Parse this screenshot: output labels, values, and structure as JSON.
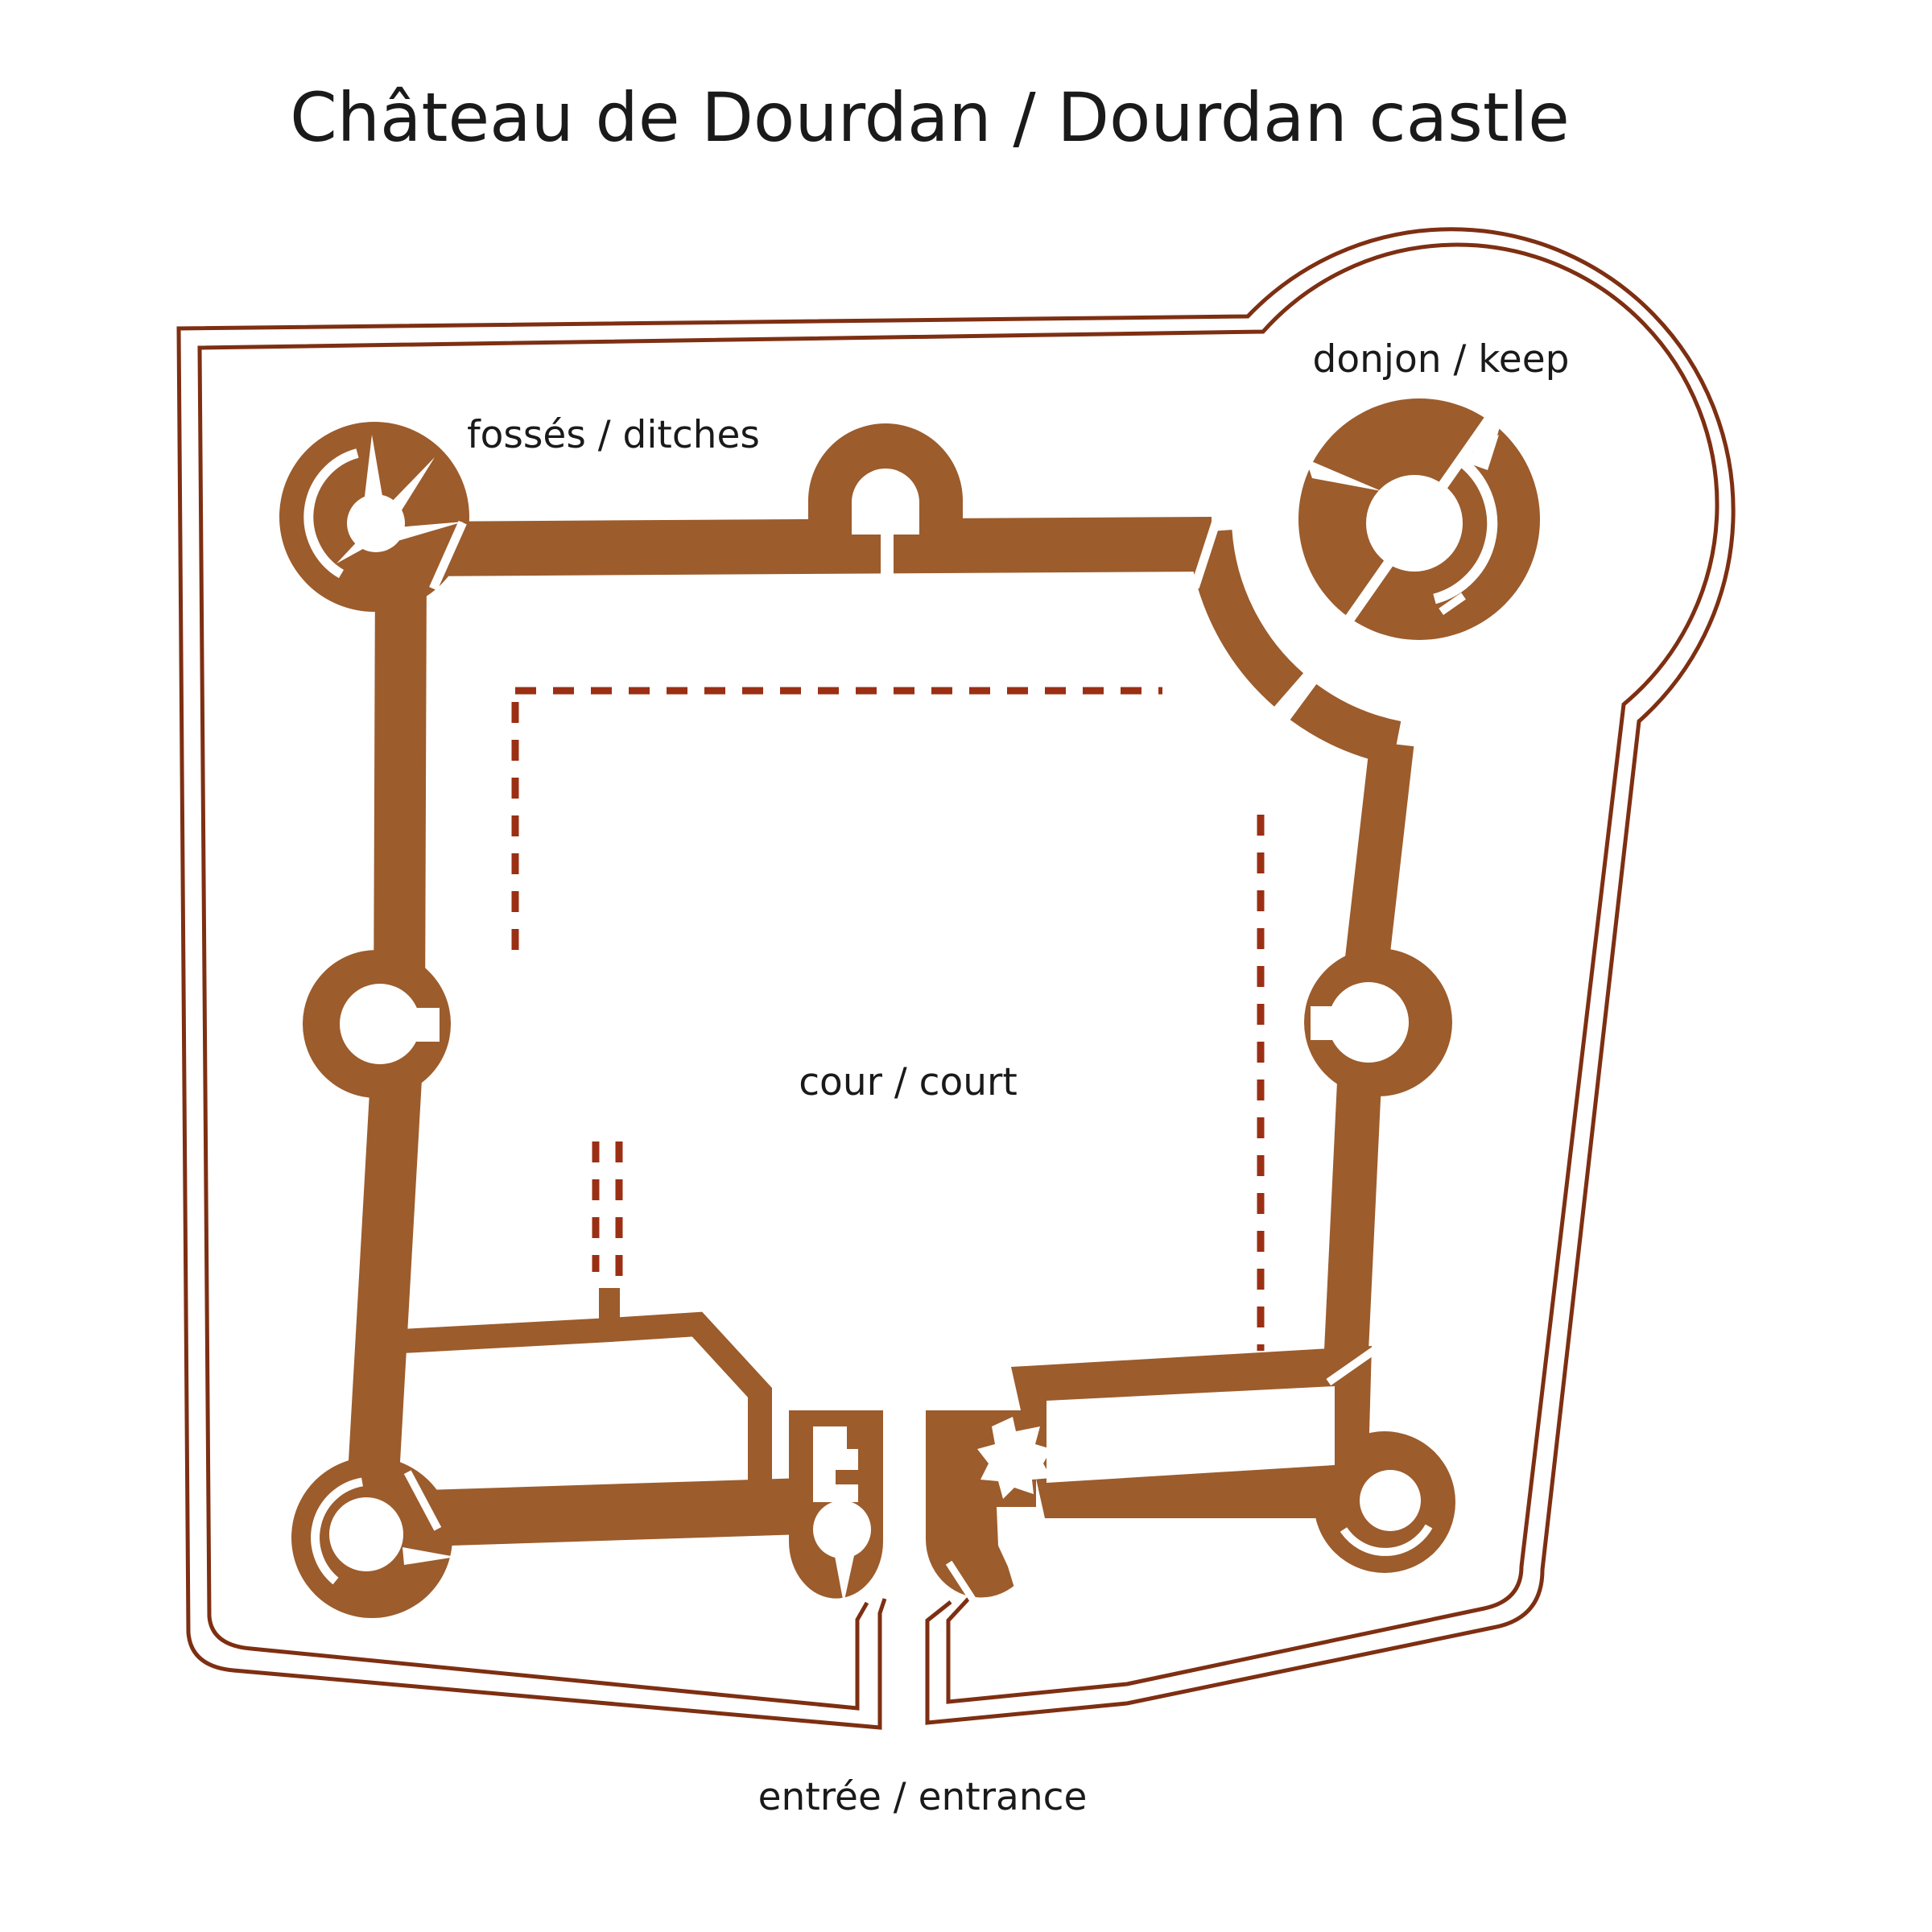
{
  "title": "Château de Dourdan / Dourdan castle",
  "labels": {
    "ditches": "fossés / ditches",
    "keep": "donjon / keep",
    "court": "cour / court",
    "entrance": "entrée / entrance"
  },
  "colors": {
    "wall": "#9c5c2c",
    "outline": "#7e2f12",
    "dash": "#9b2f14",
    "text": "#1a1a1a",
    "background": "#ffffff"
  }
}
